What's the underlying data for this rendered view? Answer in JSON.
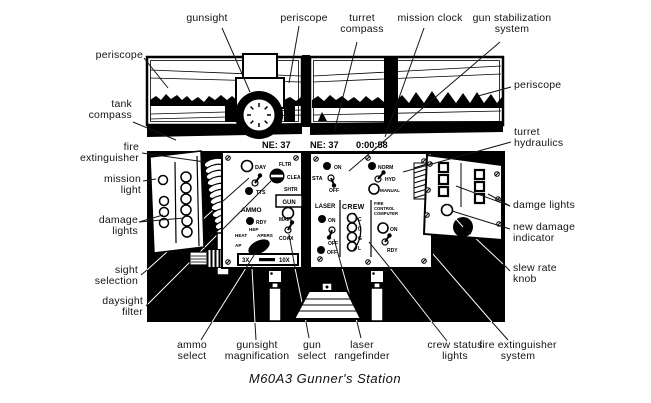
{
  "caption": "M60A3 Gunner's Station",
  "ink_color": "#000000",
  "status_display": {
    "azimuth_left": "NE: 37",
    "azimuth_right": "NE: 37",
    "clock": "0:00:58"
  },
  "callouts": {
    "gunsight": "gunsight",
    "periscope_top": "periscope",
    "turret_compass": "turret\ncompass",
    "mission_clock": "mission clock",
    "gun_stabilization": "gun stabilization\nsystem",
    "periscope_left": "periscope",
    "tank_compass": "tank\ncompass",
    "fire_extinguisher": "fire\nextinguisher",
    "mission_light": "mission\nlight",
    "damage_lights": "damage\nlights",
    "sight_selection": "sight\nselection",
    "daysight_filter": "daysight\nfilter",
    "periscope_right": "periscope",
    "turret_hydraulics": "turret\nhydraulics",
    "damge_lights": "damge lights",
    "new_damage_indicator": "new damage\nindicator",
    "slew_rate_knob": "slew rate\nknob",
    "ammo_select": "ammo\nselect",
    "gunsight_magnification": "gunsight\nmagnification",
    "gun_select": "gun\nselect",
    "laser_rangefinder": "laser\nrangefinder",
    "crew_status_lights": "crew status\nlights",
    "fire_extinguisher_system": "fire extinguisher\nsystem"
  },
  "sight_panel": {
    "day": "DAY",
    "tts": "TTS",
    "fltr": "FLTR",
    "clear": "CLEAR",
    "shtr": "SHTR",
    "ammo": "AMMO",
    "rdy": "RDY",
    "hep": "HEP",
    "heat": "HEAT",
    "apers": "APERS",
    "ap": "AP",
    "gun": "GUN",
    "main": "MAIN",
    "coax": "COAX",
    "mag_min": "3X",
    "mag_max": "10X"
  },
  "control_panel": {
    "sta": "STA",
    "sta_on": "ON",
    "sta_off": "OFF",
    "norm": "NORM",
    "hyd": "HYD",
    "manual": "MANUAL",
    "laser": "LASER",
    "laser_on": "ON",
    "laser_off": "OFF",
    "laser_off2": "OFF",
    "crew": "CREW",
    "crew_c": "C",
    "crew_d": "D",
    "crew_g": "G",
    "crew_l": "L",
    "fcc_line1": "FIRE",
    "fcc_line2": "CONTROL",
    "fcc_line3": "COMPUTER",
    "fcc_on": "ON",
    "fcc_rdy": "RDY"
  }
}
